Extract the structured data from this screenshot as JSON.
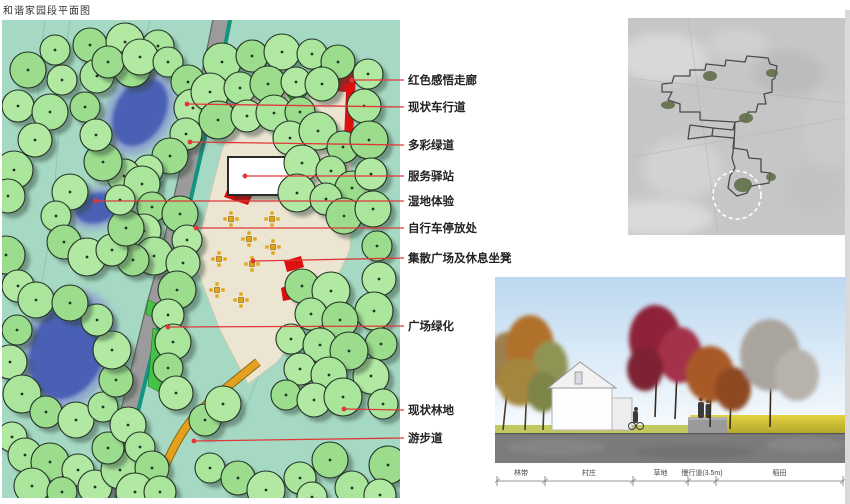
{
  "title": "和谐家园段平面图",
  "colors": {
    "plan_background": "#a5d9c3",
    "tree_green": "#a9e59b",
    "water_blue": "#4a61b4",
    "plaza_cream": "#ece5d2",
    "road_gray": "#9b9b9b",
    "greenway_teal": "#129481",
    "path_orange": "#e5a01f",
    "corridor_red": "#dd0f0f",
    "leader_red": "#e03838",
    "lawn_green": "#3fbf3f",
    "seat_orange": "#e2a51a"
  },
  "plan": {
    "labels": [
      {
        "id": "red-corridor",
        "text": "红色感悟走廊",
        "y": 80,
        "tx": 352,
        "ty": 80
      },
      {
        "id": "existing-roadway",
        "text": "现状车行道",
        "y": 107,
        "tx": 187,
        "ty": 104
      },
      {
        "id": "colorful-greenway",
        "text": "多彩绿道",
        "y": 145,
        "tx": 190,
        "ty": 142
      },
      {
        "id": "service-station",
        "text": "服务驿站",
        "y": 176,
        "tx": 245,
        "ty": 176
      },
      {
        "id": "wetland-experience",
        "text": "湿地体验",
        "y": 201,
        "tx": 96,
        "ty": 201
      },
      {
        "id": "bike-parking",
        "text": "自行车停放处",
        "y": 228,
        "tx": 196,
        "ty": 228
      },
      {
        "id": "plaza-seating",
        "text": "集散广场及休息坐凳",
        "y": 258,
        "tx": 253,
        "ty": 261
      },
      {
        "id": "plaza-greening",
        "text": "广场绿化",
        "y": 326,
        "tx": 168,
        "ty": 327
      },
      {
        "id": "existing-woodland",
        "text": "现状林地",
        "y": 410,
        "tx": 344,
        "ty": 409
      },
      {
        "id": "walking-path",
        "text": "游步道",
        "y": 438,
        "tx": 194,
        "ty": 441
      }
    ],
    "trees": [
      [
        55,
        50
      ],
      [
        90,
        45
      ],
      [
        125,
        42
      ],
      [
        158,
        46
      ],
      [
        28,
        70
      ],
      [
        62,
        80
      ],
      [
        97,
        76
      ],
      [
        132,
        68
      ],
      [
        18,
        106
      ],
      [
        50,
        112
      ],
      [
        85,
        107
      ],
      [
        35,
        140
      ],
      [
        14,
        170
      ],
      [
        108,
        62
      ],
      [
        140,
        57
      ],
      [
        168,
        62
      ],
      [
        188,
        82
      ],
      [
        193,
        108
      ],
      [
        186,
        134
      ],
      [
        170,
        156
      ],
      [
        148,
        170
      ],
      [
        124,
        176
      ],
      [
        103,
        162
      ],
      [
        96,
        135
      ],
      [
        142,
        184
      ],
      [
        152,
        207
      ],
      [
        144,
        231
      ],
      [
        154,
        256
      ],
      [
        133,
        260
      ],
      [
        70,
        192
      ],
      [
        56,
        216
      ],
      [
        64,
        242
      ],
      [
        87,
        257
      ],
      [
        112,
        250
      ],
      [
        126,
        228
      ],
      [
        120,
        200
      ],
      [
        8,
        196
      ],
      [
        6,
        255
      ],
      [
        18,
        286
      ],
      [
        36,
        300
      ],
      [
        17,
        330
      ],
      [
        10,
        362
      ],
      [
        22,
        394
      ],
      [
        46,
        412
      ],
      [
        76,
        420
      ],
      [
        103,
        407
      ],
      [
        116,
        380
      ],
      [
        112,
        350
      ],
      [
        97,
        320
      ],
      [
        70,
        303
      ],
      [
        12,
        437
      ],
      [
        25,
        455
      ],
      [
        50,
        462
      ],
      [
        78,
        470
      ],
      [
        32,
        486
      ],
      [
        62,
        492
      ],
      [
        95,
        487
      ],
      [
        120,
        470
      ],
      [
        108,
        448
      ],
      [
        128,
        425
      ],
      [
        140,
        447
      ],
      [
        152,
        468
      ],
      [
        135,
        492
      ],
      [
        160,
        492
      ],
      [
        180,
        214
      ],
      [
        187,
        240
      ],
      [
        183,
        263
      ],
      [
        177,
        290
      ],
      [
        168,
        315
      ],
      [
        173,
        342
      ],
      [
        168,
        368
      ],
      [
        176,
        393
      ],
      [
        222,
        62
      ],
      [
        252,
        56
      ],
      [
        282,
        52
      ],
      [
        312,
        54
      ],
      [
        338,
        62
      ],
      [
        210,
        92
      ],
      [
        240,
        88
      ],
      [
        268,
        84
      ],
      [
        296,
        82
      ],
      [
        322,
        84
      ],
      [
        218,
        120
      ],
      [
        247,
        116
      ],
      [
        274,
        113
      ],
      [
        300,
        112
      ],
      [
        290,
        138
      ],
      [
        318,
        131
      ],
      [
        343,
        147
      ],
      [
        302,
        163
      ],
      [
        331,
        171
      ],
      [
        352,
        188
      ],
      [
        297,
        193
      ],
      [
        326,
        199
      ],
      [
        344,
        216
      ],
      [
        368,
        74
      ],
      [
        364,
        106
      ],
      [
        369,
        140
      ],
      [
        371,
        174
      ],
      [
        373,
        209
      ],
      [
        377,
        246
      ],
      [
        379,
        279
      ],
      [
        374,
        311
      ],
      [
        381,
        344
      ],
      [
        371,
        376
      ],
      [
        383,
        404
      ],
      [
        302,
        286
      ],
      [
        331,
        291
      ],
      [
        311,
        314
      ],
      [
        340,
        320
      ],
      [
        291,
        339
      ],
      [
        320,
        345
      ],
      [
        349,
        351
      ],
      [
        300,
        369
      ],
      [
        329,
        375
      ],
      [
        286,
        395
      ],
      [
        314,
        400
      ],
      [
        343,
        397
      ],
      [
        205,
        420
      ],
      [
        223,
        404
      ],
      [
        210,
        468
      ],
      [
        238,
        478
      ],
      [
        266,
        490
      ],
      [
        300,
        478
      ],
      [
        330,
        460
      ],
      [
        312,
        497
      ],
      [
        352,
        488
      ],
      [
        388,
        465
      ],
      [
        380,
        495
      ]
    ],
    "seat_markers": [
      [
        231,
        219
      ],
      [
        272,
        219
      ],
      [
        249,
        239
      ],
      [
        273,
        247
      ],
      [
        219,
        259
      ],
      [
        252,
        264
      ],
      [
        217,
        290
      ],
      [
        241,
        300
      ]
    ]
  },
  "section": {
    "ticks": [
      2,
      50,
      138,
      193,
      221,
      348
    ],
    "dim_labels": [
      {
        "id": "green-belt",
        "text": "林带"
      },
      {
        "id": "village",
        "text": "村庄"
      },
      {
        "id": "lawn",
        "text": "草地"
      },
      {
        "id": "slow-lane",
        "text": "慢行道(3.5m)"
      },
      {
        "id": "paddy-field",
        "text": "稻田"
      }
    ]
  }
}
